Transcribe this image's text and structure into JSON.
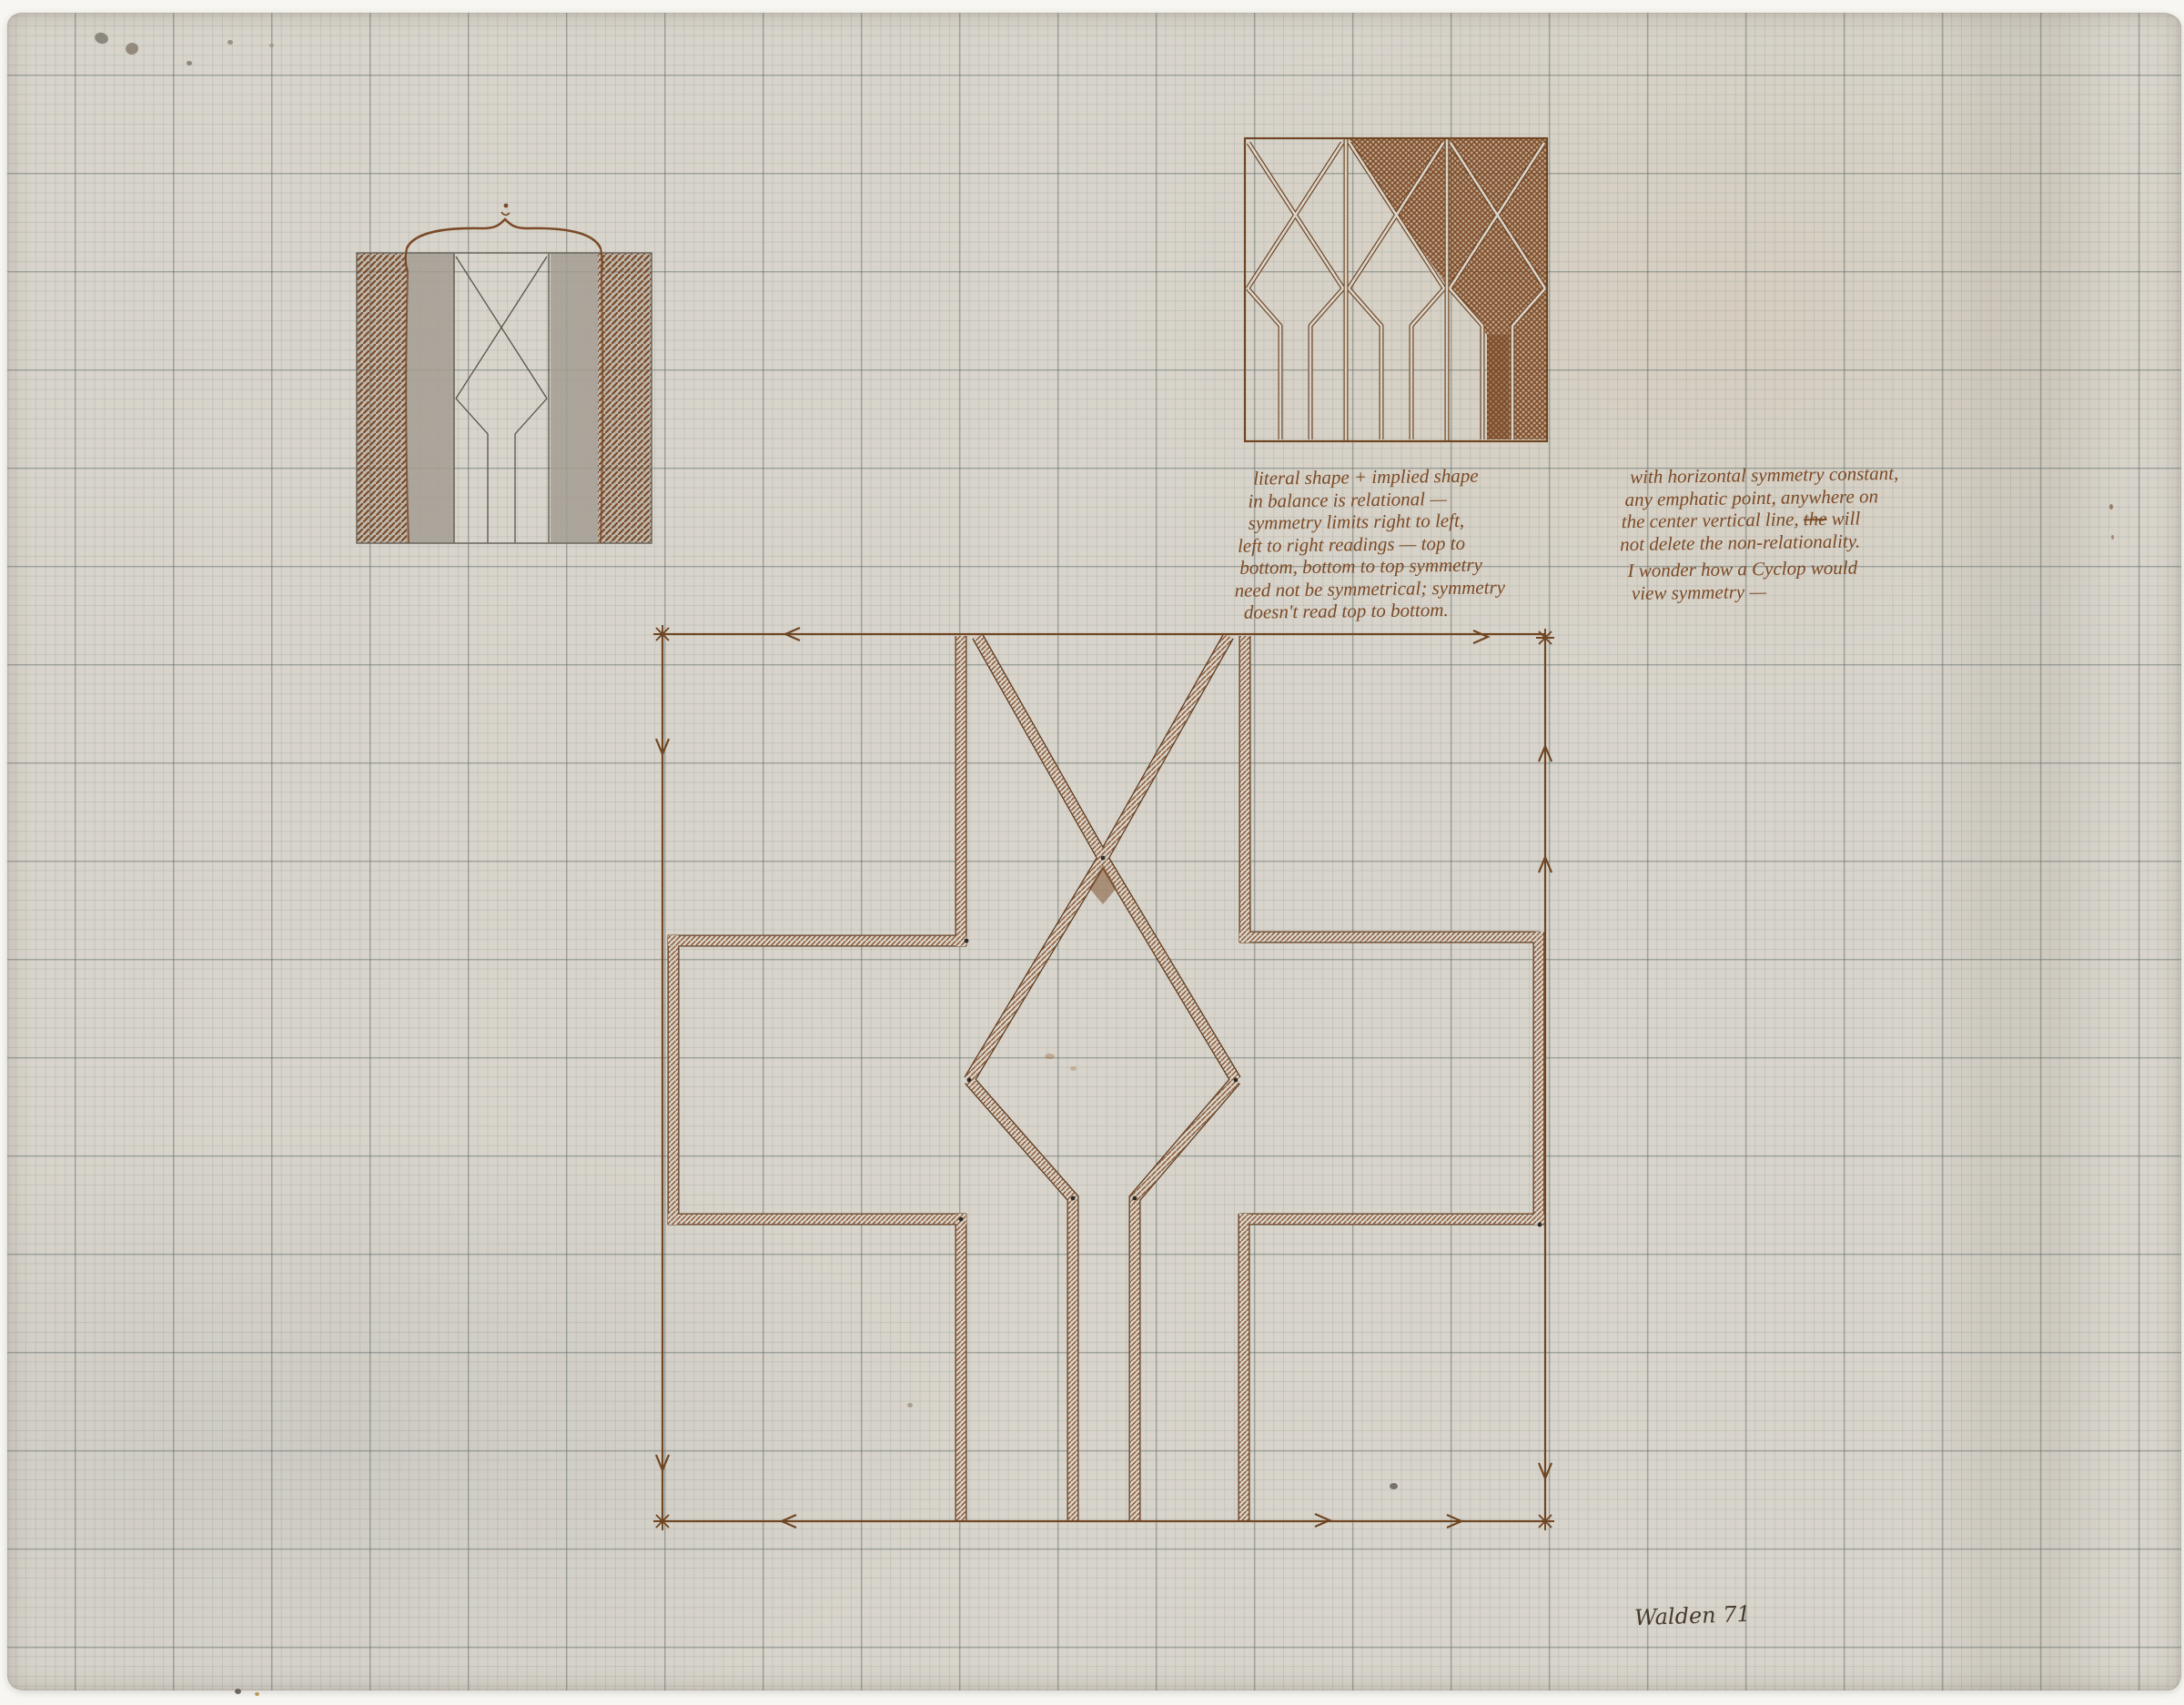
{
  "artwork": {
    "colors": {
      "ink_brown": "#7b4a26",
      "band_edge": "#5e3a1e",
      "pencil_gray": "#6e6a62",
      "paper": "#d8d4cb"
    }
  },
  "annotations": {
    "note_center": {
      "lines": [
        "literal shape + implied shape",
        "in balance is relational —",
        "symmetry limits right to left,",
        "left to right readings — top to",
        "bottom, bottom to top symmetry",
        "need not be symmetrical; symmetry",
        "doesn't read top to bottom."
      ]
    },
    "note_right": {
      "line1": "with horizontal symmetry constant,",
      "line2": "any emphatic point, anywhere on",
      "line3_pre": "the center vertical line, ",
      "line3_struck": "the",
      "line3_post": " will",
      "line4": "not delete the non-relationality.",
      "line5": "I wonder how a Cyclop would",
      "line6": "view symmetry —"
    },
    "signature": "Walden 71"
  }
}
